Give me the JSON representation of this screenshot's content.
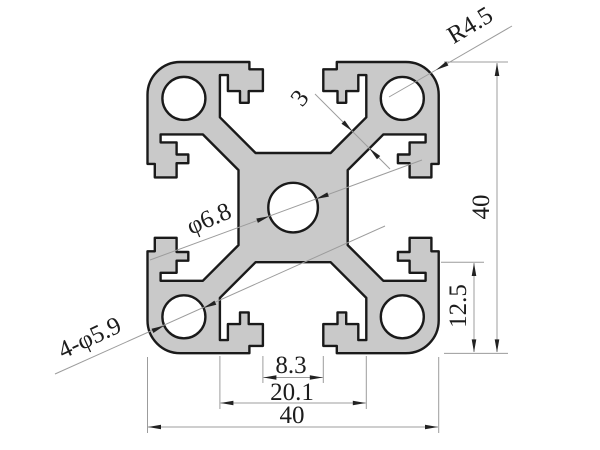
{
  "drawing": {
    "title": "4040 aluminum extrusion profile cross-section",
    "background_color": "#ffffff",
    "profile_fill_color": "#c9c9c9",
    "outline_color": "#1a1a1a",
    "dim_line_color": "#9c9c9c",
    "arrow_color": "#222222",
    "text_color": "#1c1c1c",
    "dimensions": {
      "corner_radius": {
        "label": "R4.5"
      },
      "height": {
        "label": "40"
      },
      "slot_depth": {
        "label": "12.5"
      },
      "slot_opening": {
        "label": "8.3"
      },
      "cavity_width": {
        "label": "20.1"
      },
      "width": {
        "label": "40"
      },
      "web_thickness": {
        "label": "3"
      },
      "center_hole": {
        "label": "φ6.8"
      },
      "corner_holes": {
        "label": "4-φ5.9"
      }
    }
  }
}
